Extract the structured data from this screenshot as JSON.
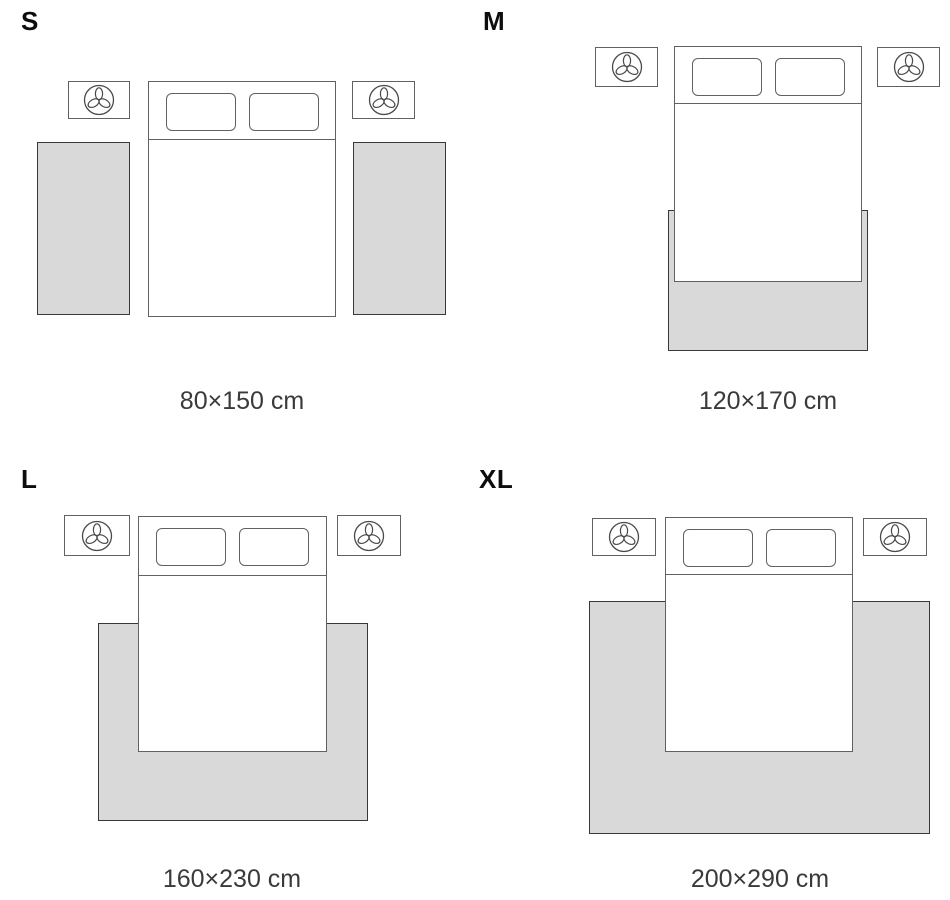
{
  "title": "Rug size guide",
  "colors": {
    "background": "#ffffff",
    "rug_fill": "#d9d9d9",
    "rug_border": "#383838",
    "furniture_border": "#616161",
    "letter_color": "#0d0d0d",
    "label_color": "#3a3a3a"
  },
  "icons": {
    "nightstand_decor": "plant-icon"
  },
  "panels": [
    {
      "id": "S",
      "letter": "S",
      "dimensions": "80×150 cm",
      "rug_layout": "two bedside runners"
    },
    {
      "id": "M",
      "letter": "M",
      "dimensions": "120×170 cm",
      "rug_layout": "under foot of bed"
    },
    {
      "id": "L",
      "letter": "L",
      "dimensions": "160×230 cm",
      "rug_layout": "under lower two-thirds of bed"
    },
    {
      "id": "XL",
      "letter": "XL",
      "dimensions": "200×290 cm",
      "rug_layout": "under bed reaching nightstand width"
    }
  ]
}
